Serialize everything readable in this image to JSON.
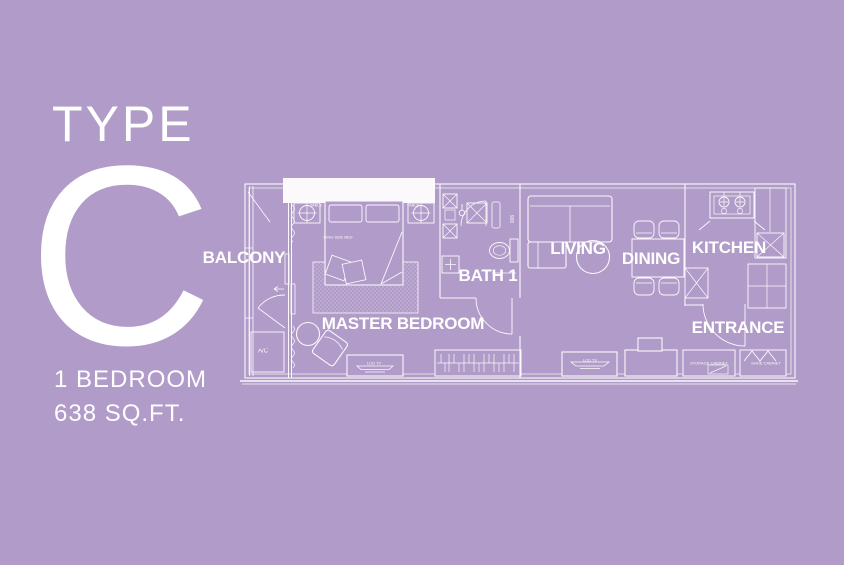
{
  "panel": {
    "type_label": "TYPE",
    "type_letter": "C",
    "bedrooms": "1 BEDROOM",
    "area": "638 SQ.FT."
  },
  "plan": {
    "rooms": [
      {
        "label": "BALCONY"
      },
      {
        "label": "MASTER BEDROOM"
      },
      {
        "label": "BATH 1"
      },
      {
        "label": "LIVING"
      },
      {
        "label": "DINING"
      },
      {
        "label": "KITCHEN"
      },
      {
        "label": "ENTRANCE"
      }
    ],
    "fixtures": {
      "ac": "A/C",
      "bedside_table": "BEDSIDE TABLE",
      "king_bed": "KING SIZE BED",
      "lcd_tv": "LCD TV",
      "storage_cabinet": "STORAGE CABINET",
      "shoe_cabinet": "SHOE CABINET",
      "shower_dim": "900"
    }
  },
  "colors": {
    "background": "#b19bc8",
    "line": "#ffffff"
  }
}
